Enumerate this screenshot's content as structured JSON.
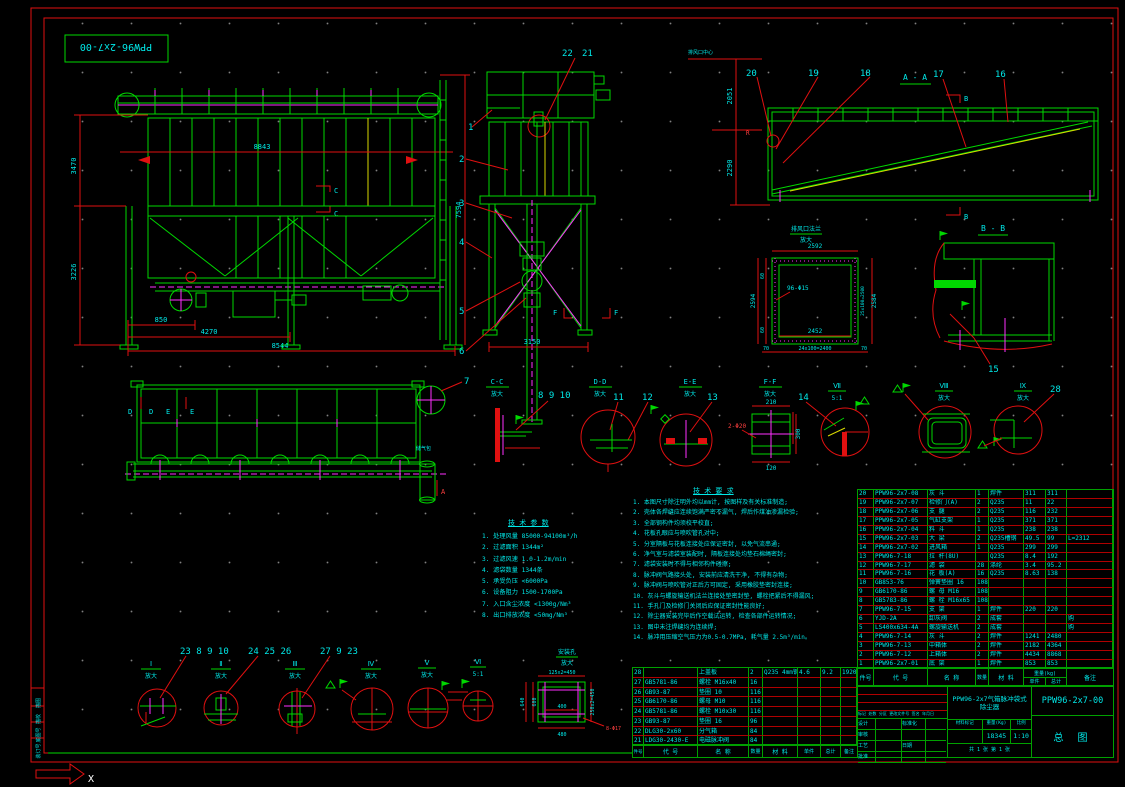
{
  "sheet": {
    "border_label": "PPW96-2x7-00",
    "ucs_x": "X",
    "strip_cells": [
      "描图",
      "描校",
      "底图号",
      "装订号"
    ]
  },
  "front": {
    "dim_top": "8843",
    "dim_left_upper": "3470",
    "dim_left_lower": "3226",
    "dim_b1": "850",
    "dim_b2": "4270",
    "dim_b3": "8544",
    "dim_right": "7594",
    "sec_c": "C"
  },
  "side": {
    "b1": "1",
    "b2": "2",
    "b3": "3",
    "b4": "4",
    "b5": "5",
    "b6": "6",
    "b21": "21",
    "b22": "22",
    "dim_bottom": "3150",
    "sec_f": "F"
  },
  "aa": {
    "title": "A - A",
    "b16": "16",
    "b17": "17",
    "b18": "18",
    "b19": "19",
    "b20": "20",
    "dim_u": "2051",
    "dim_l": "2290",
    "top_label": "排风口中心",
    "sec_b": "B",
    "r": "R"
  },
  "flange": {
    "t1": "排风口法兰",
    "t2": "放大",
    "d_top": "2592",
    "d_left": "2594",
    "d60": "60",
    "d_right": "2584",
    "d_right2": "25x100=2500",
    "d_inner": "2452",
    "d_bottom": "24x100=2400",
    "d70": "70",
    "holes": "96-Φ15"
  },
  "bb": {
    "title": "B - B",
    "b15": "15"
  },
  "plan": {
    "d": "D",
    "e": "E",
    "a": "A",
    "b7": "7",
    "tank": "储气包"
  },
  "band": {
    "cc": {
      "t": "C-C",
      "s": "放大",
      "bal": "8  9  10"
    },
    "dd": {
      "t": "D-D",
      "s": "放大",
      "b11": "11",
      "b12": "12"
    },
    "ee": {
      "t": "E-E",
      "s": "放大",
      "b13": "13"
    },
    "ff": {
      "t": "F-F",
      "s": "放大",
      "d_top": "210",
      "d_right": "300",
      "d_bottom": "120",
      "holes": "2-Φ20"
    },
    "v7": {
      "t": "Ⅶ",
      "s": "5:1",
      "b14": "14"
    },
    "v8": {
      "t": "Ⅷ",
      "s": "放大"
    },
    "v9": {
      "t": "Ⅸ",
      "s": "放大",
      "b28": "28"
    }
  },
  "bottom": {
    "i": {
      "t": "Ⅰ",
      "s": "放大",
      "bal": "23  8  9  10"
    },
    "ii": {
      "t": "Ⅱ",
      "s": "放大",
      "bal": "24 25 26"
    },
    "iii": {
      "t": "Ⅲ",
      "s": "放大",
      "bal": "27  9  23"
    },
    "iv": {
      "t": "Ⅳ",
      "s": "放大"
    },
    "v": {
      "t": "Ⅴ",
      "s": "放大"
    },
    "vi": {
      "t": "Ⅵ",
      "s": "5:1"
    },
    "sq": {
      "t1": "安装孔",
      "t2": "放大",
      "d_top": "125x2=450",
      "d_l1": "640",
      "d_l2": "600",
      "d_right": "250x2=450",
      "d_in": "400",
      "d_bottom": "480",
      "holes": "8-Φ17"
    }
  },
  "params": {
    "title": "技 术 参 数",
    "items": [
      "1. 处理风量 85000-94100m³/h",
      "2. 过滤面积 1344m²",
      "3. 过滤风速 1.0-1.2m/min",
      "4. 滤袋数量 1344条",
      "5. 承受负压 <6000Pa",
      "6. 设备阻力 1500-1700Pa",
      "7. 入口含尘浓度 <1300g/Nm³",
      "8. 出口排放浓度 <50mg/Nm³"
    ]
  },
  "notes": {
    "title": "技 术 要 求",
    "items": [
      "1. 本图尺寸除注明外均以mm计, 按图样及有关标准制造;",
      "2. 壳体各焊缝应连续饱满严密不漏气, 焊后作煤油渗漏检验;",
      "3. 全部钢构件均须校平校直;",
      "4. 花板孔眼应与喷吹管孔对中;",
      "5. 分室隔板与花板连接处应保证密封, 以免气流串通;",
      "6. 净气室与滤袋室装配时, 隔板连接处均垫石棉绳密封;",
      "7. 滤袋安装时不得与相邻构件碰擦;",
      "8. 脉冲阀气路接头处, 安装前应清洗干净, 不得有杂物;",
      "9. 脉冲阀与喷吹管对正后方可固定, 采用橡胶垫密封连接;",
      "10. 灰斗与螺旋输送机法兰连接处垫密封垫, 螺栓把紧后不得漏风;",
      "11. 手孔门及检修门关闭后应保证密封性能良好;",
      "12. 除尘器安装完毕后作空载试运转, 检查各部件运转情况;",
      "13. 图中未注焊缝均为连续焊;",
      "14. 脉冲用压缩空气压力为0.5-0.7MPa, 耗气量 2.5m³/min。"
    ]
  },
  "table_headers": {
    "no": "件号",
    "code": "代  号",
    "name": "名  称",
    "qty": "数量",
    "mat": "材  料",
    "weight": "重量(kg)",
    "uw": "单件",
    "tw": "总计",
    "rem": "备注"
  },
  "parts_main": {
    "rows": [
      {
        "n": "20",
        "c": "PPW96-2x7-08",
        "m": "灰  斗",
        "q": "1",
        "mt": "焊件",
        "u": "311",
        "t": "311",
        "r": ""
      },
      {
        "n": "19",
        "c": "PPW96-2x7-07",
        "m": "检修门(A)",
        "q": "2",
        "mt": "Q235",
        "u": "11",
        "t": "22",
        "r": ""
      },
      {
        "n": "18",
        "c": "PPW96-2x7-06",
        "m": "支  腿",
        "q": "2",
        "mt": "Q235",
        "u": "116",
        "t": "232",
        "r": ""
      },
      {
        "n": "17",
        "c": "PPW96-2x7-05",
        "m": "气缸支架",
        "q": "1",
        "mt": "Q235",
        "u": "371",
        "t": "371",
        "r": ""
      },
      {
        "n": "16",
        "c": "PPW96-2x7-04",
        "m": "料  斗",
        "q": "1",
        "mt": "Q235",
        "u": "238",
        "t": "238",
        "r": ""
      },
      {
        "n": "15",
        "c": "PPW96-2x7-03",
        "m": "大  梁",
        "q": "2",
        "mt": "Q235槽钢",
        "u": "49.5",
        "t": "99",
        "r": "L=2312"
      },
      {
        "n": "14",
        "c": "PPW96-2x7-02",
        "m": "进风箱",
        "q": "1",
        "mt": "Q235",
        "u": "299",
        "t": "299",
        "r": ""
      },
      {
        "n": "13",
        "c": "PPW96-7-18",
        "m": "拉 杆(8U)",
        "q": "",
        "mt": "Q235",
        "u": "8.4",
        "t": "192",
        "r": ""
      },
      {
        "n": "12",
        "c": "PPW96-7-17",
        "m": "滤  袋",
        "q": "28",
        "mt": "涤纶",
        "u": "3.4",
        "t": "95.2",
        "r": ""
      },
      {
        "n": "11",
        "c": "PPW96-7-16",
        "m": "花 板(A)",
        "q": "16",
        "mt": "Q235",
        "u": "8.63",
        "t": "138",
        "r": ""
      },
      {
        "n": "10",
        "c": "GB853-76",
        "m": "弹簧垫圈 16",
        "q": "108",
        "mt": "",
        "u": "",
        "t": "",
        "r": ""
      },
      {
        "n": "9",
        "c": "GB6170-86",
        "m": "螺 母 M16",
        "q": "108",
        "mt": "",
        "u": "",
        "t": "",
        "r": ""
      },
      {
        "n": "8",
        "c": "GB5783-86",
        "m": "螺 栓 M16x65",
        "q": "108",
        "mt": "",
        "u": "",
        "t": "",
        "r": ""
      },
      {
        "n": "7",
        "c": "PPW96-7-15",
        "m": "支  架",
        "q": "1",
        "mt": "焊件",
        "u": "220",
        "t": "220",
        "r": ""
      },
      {
        "n": "6",
        "c": "YJD-2A",
        "m": "卸灰阀",
        "q": "2",
        "mt": "成套",
        "u": "",
        "t": "",
        "r": "购"
      },
      {
        "n": "5",
        "c": "LS400x634-4A",
        "m": "螺旋输送机",
        "q": "2",
        "mt": "成套",
        "u": "",
        "t": "",
        "r": "购"
      },
      {
        "n": "4",
        "c": "PPW96-7-14",
        "m": "灰  斗",
        "q": "2",
        "mt": "焊件",
        "u": "1241",
        "t": "2480",
        "r": ""
      },
      {
        "n": "3",
        "c": "PPW96-7-13",
        "m": "中箱体",
        "q": "2",
        "mt": "焊件",
        "u": "2182",
        "t": "4364",
        "r": ""
      },
      {
        "n": "2",
        "c": "PPW96-7-12",
        "m": "上箱体",
        "q": "2",
        "mt": "焊件",
        "u": "4434",
        "t": "8868",
        "r": ""
      },
      {
        "n": "1",
        "c": "PPW96-2x7-01",
        "m": "底  架",
        "q": "1",
        "mt": "焊件",
        "u": "853",
        "t": "853",
        "r": ""
      }
    ]
  },
  "parts_aux": {
    "rows": [
      {
        "n": "28",
        "c": "",
        "m": "上盖板",
        "q": "2",
        "mt": "Q235 4mm钢板",
        "u": "4.6",
        "t": "9.2",
        "r": "1920x1100"
      },
      {
        "n": "27",
        "c": "GB5781-86",
        "m": "螺栓 M16x40",
        "q": "16",
        "mt": "",
        "u": "",
        "t": "",
        "r": ""
      },
      {
        "n": "26",
        "c": "GB93-87",
        "m": "垫圈 10",
        "q": "116",
        "mt": "",
        "u": "",
        "t": "",
        "r": ""
      },
      {
        "n": "25",
        "c": "GB6170-86",
        "m": "螺母 M10",
        "q": "116",
        "mt": "",
        "u": "",
        "t": "",
        "r": ""
      },
      {
        "n": "24",
        "c": "GB5781-86",
        "m": "螺栓 M10x30",
        "q": "116",
        "mt": "",
        "u": "",
        "t": "",
        "r": ""
      },
      {
        "n": "23",
        "c": "GB93-87",
        "m": "垫圈 16",
        "q": "96",
        "mt": "",
        "u": "",
        "t": "",
        "r": ""
      },
      {
        "n": "22",
        "c": "DLG30-2x60",
        "m": "分气箱",
        "q": "84",
        "mt": "",
        "u": "",
        "t": "",
        "r": ""
      },
      {
        "n": "21",
        "c": "LDG30-2430-E",
        "m": "电磁脉冲阀",
        "q": "84",
        "mt": "",
        "u": "",
        "t": "",
        "r": ""
      }
    ]
  },
  "title_block": {
    "product": "PPW96-2x7气箱脉冲袋式除尘器",
    "drawing_no": "PPW96-2x7-00",
    "type_label": "总  图",
    "material_label": "材料标记",
    "weight_label": "重量(Kg)",
    "weight": "18345",
    "scale_label": "比例",
    "scale": "1:10",
    "sheet_label": "共 1 张  第 1 张",
    "rev_header": "标记 处数 分区 更改文件号 签名 年月日",
    "roles": [
      {
        "l1": "设计",
        "l2": "标准化"
      },
      {
        "l1": "审核",
        "l2": ""
      },
      {
        "l1": "工艺",
        "l2": "日期"
      },
      {
        "l1": "批准",
        "l2": ""
      }
    ]
  }
}
